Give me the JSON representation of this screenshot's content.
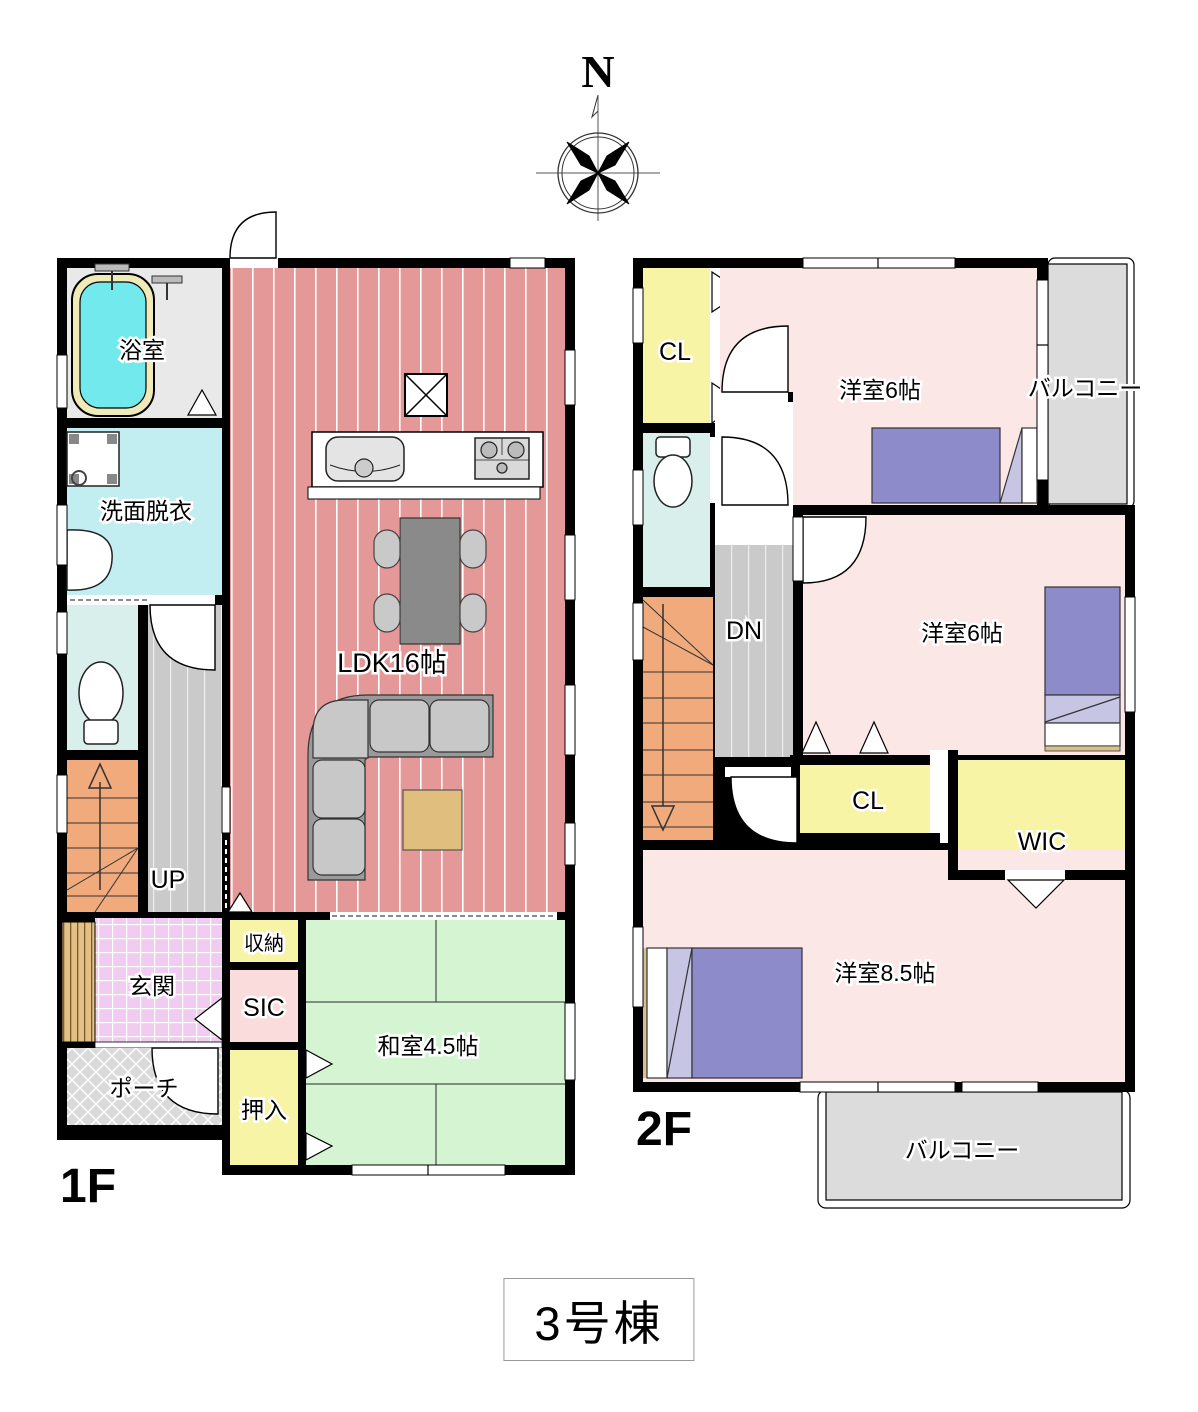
{
  "compass": {
    "north": "N"
  },
  "title": "3号棟",
  "floor1": {
    "floor_label": "1F",
    "rooms": {
      "bath": "浴室",
      "washroom": "洗面脱衣",
      "ldk": "LDK16帖",
      "stairs": "UP",
      "storage": "収納",
      "sic": "SIC",
      "genkan": "玄関",
      "porch": "ポーチ",
      "tatami": "和室4.5帖",
      "oshiire": "押入"
    }
  },
  "floor2": {
    "floor_label": "2F",
    "rooms": {
      "closet1": "CL",
      "bedroom1": "洋室6帖",
      "balcony1": "バルコニー",
      "stairs": "DN",
      "bedroom2": "洋室6帖",
      "closet2": "CL",
      "wic": "WIC",
      "bedroom3": "洋室8.5帖",
      "balcony2": "バルコニー"
    }
  },
  "colors": {
    "wall": "#000000",
    "ldk_floor": "#e59898",
    "tatami_green": "#d4f4d2",
    "bedroom_pink": "#fbe7e6",
    "closet_yellow": "#f8f4a6",
    "stairs_orange": "#f0aa7c",
    "hall_gray": "#cacaca",
    "balcony_gray": "#dcdcdc",
    "bathtub_cyan": "#72e9ed",
    "washroom_cyan": "#c2eef2",
    "toilet_cyan": "#d8efec",
    "genkan_pink": "#f1cbf1",
    "sic_pink": "#fbdcdc",
    "bed_purple": "#8d8bc9",
    "porch_gray": "#dadada",
    "wood_tan": "#e3c186"
  }
}
